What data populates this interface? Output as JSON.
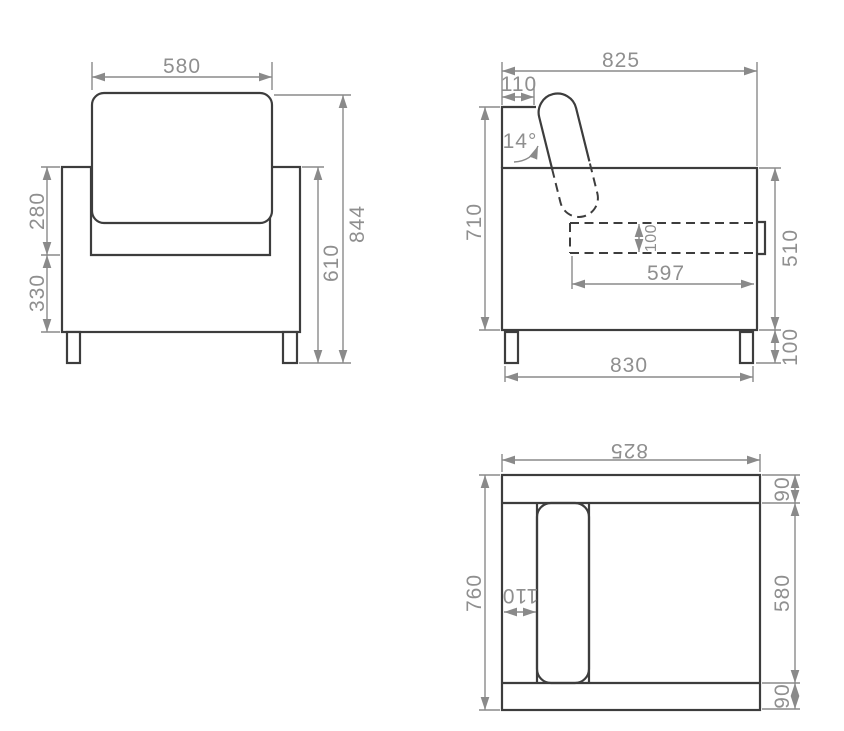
{
  "drawing_type": "furniture dimension drawing (armchair, three orthographic views)",
  "colors": {
    "background": "#ffffff",
    "outline": "#3d3d3d",
    "dimension_lines": "#8a8a8a",
    "dimension_text": "#8f8f8f"
  },
  "views": {
    "front": {
      "width_top": "580",
      "back_height": "280",
      "arm_height": "330",
      "body_height": "610",
      "total_height": "844"
    },
    "side": {
      "total_depth": "825",
      "back_depth": "110",
      "back_angle": "14°",
      "height": "710",
      "cushion_thickness": "100",
      "seat_depth": "597",
      "frame_height": "510",
      "leg_height": "100",
      "base_depth": "830"
    },
    "top": {
      "width": "825",
      "depth": "760",
      "armrest_width": "110",
      "seat_depth": "580",
      "back_band": "90",
      "front_band": "90"
    }
  }
}
